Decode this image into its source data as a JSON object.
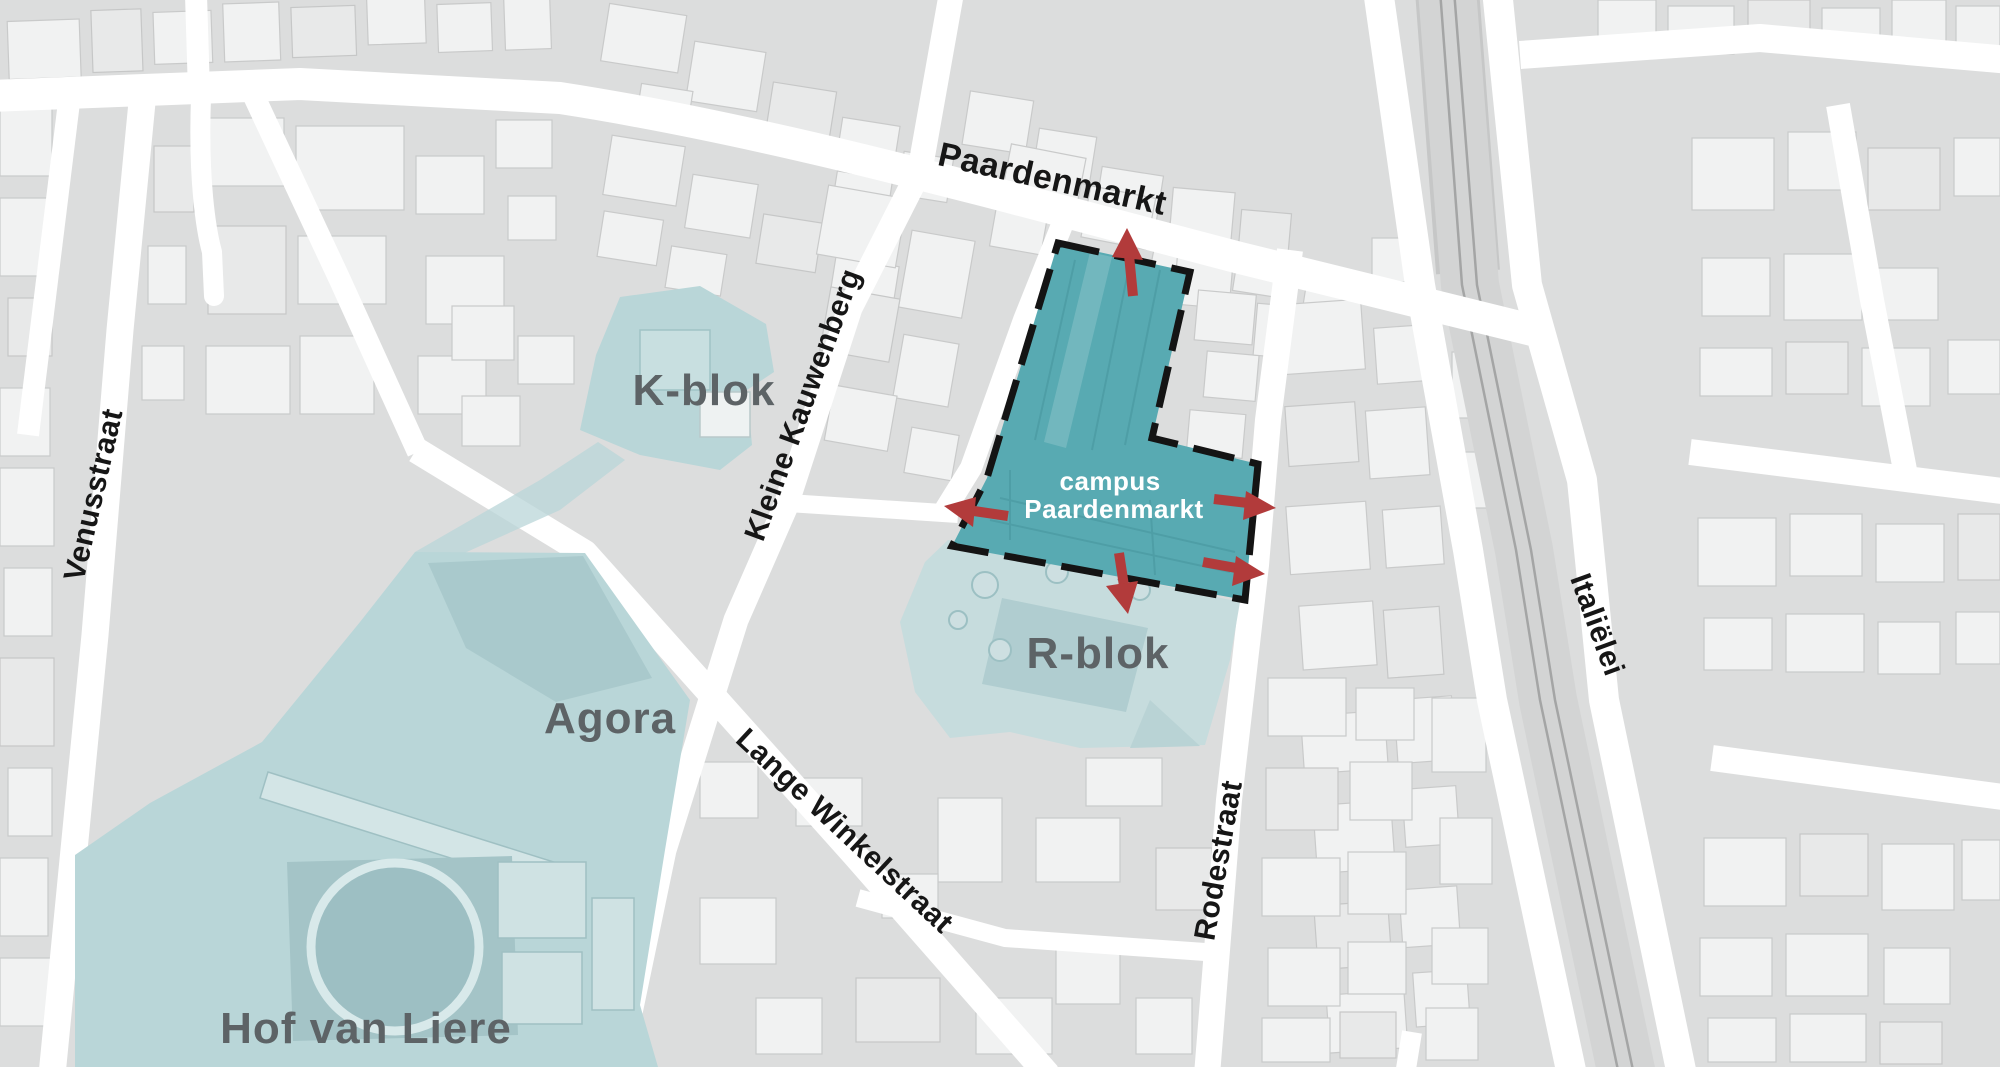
{
  "map": {
    "description": "City plan highlighting campus Paardenmarkt and surrounding university sites"
  },
  "streets": {
    "paardenmarkt": "Paardenmarkt",
    "kleine_kauwenberg": "Kleine Kauwenberg",
    "venusstraat": "Venusstraat",
    "lange_winkelstraat": "Lange Winkelstraat",
    "rodestraat": "Rodestraat",
    "italielei": "Italiëlei"
  },
  "areas": {
    "k_blok": "K-blok",
    "agora": "Agora",
    "hof_van_liere": "Hof van Liere",
    "r_blok": "R-blok"
  },
  "campus": {
    "line1": "campus",
    "line2": "Paardenmarkt"
  },
  "arrows": [
    {
      "name": "exit-arrow-north",
      "direction": "up"
    },
    {
      "name": "exit-arrow-west",
      "direction": "left"
    },
    {
      "name": "exit-arrow-east-upper",
      "direction": "right"
    },
    {
      "name": "exit-arrow-east-lower",
      "direction": "right"
    },
    {
      "name": "exit-arrow-south",
      "direction": "down"
    }
  ],
  "colors": {
    "campus_fill": "#58aab2",
    "campus_border": "#141414",
    "arrow_red": "#b23b3b",
    "zone_teal": "#b9d6d8",
    "zone_teal_light": "#c6dcdd",
    "label_gray": "#5d6366",
    "street_label": "#161616",
    "map_bg": "#dcdddd"
  }
}
